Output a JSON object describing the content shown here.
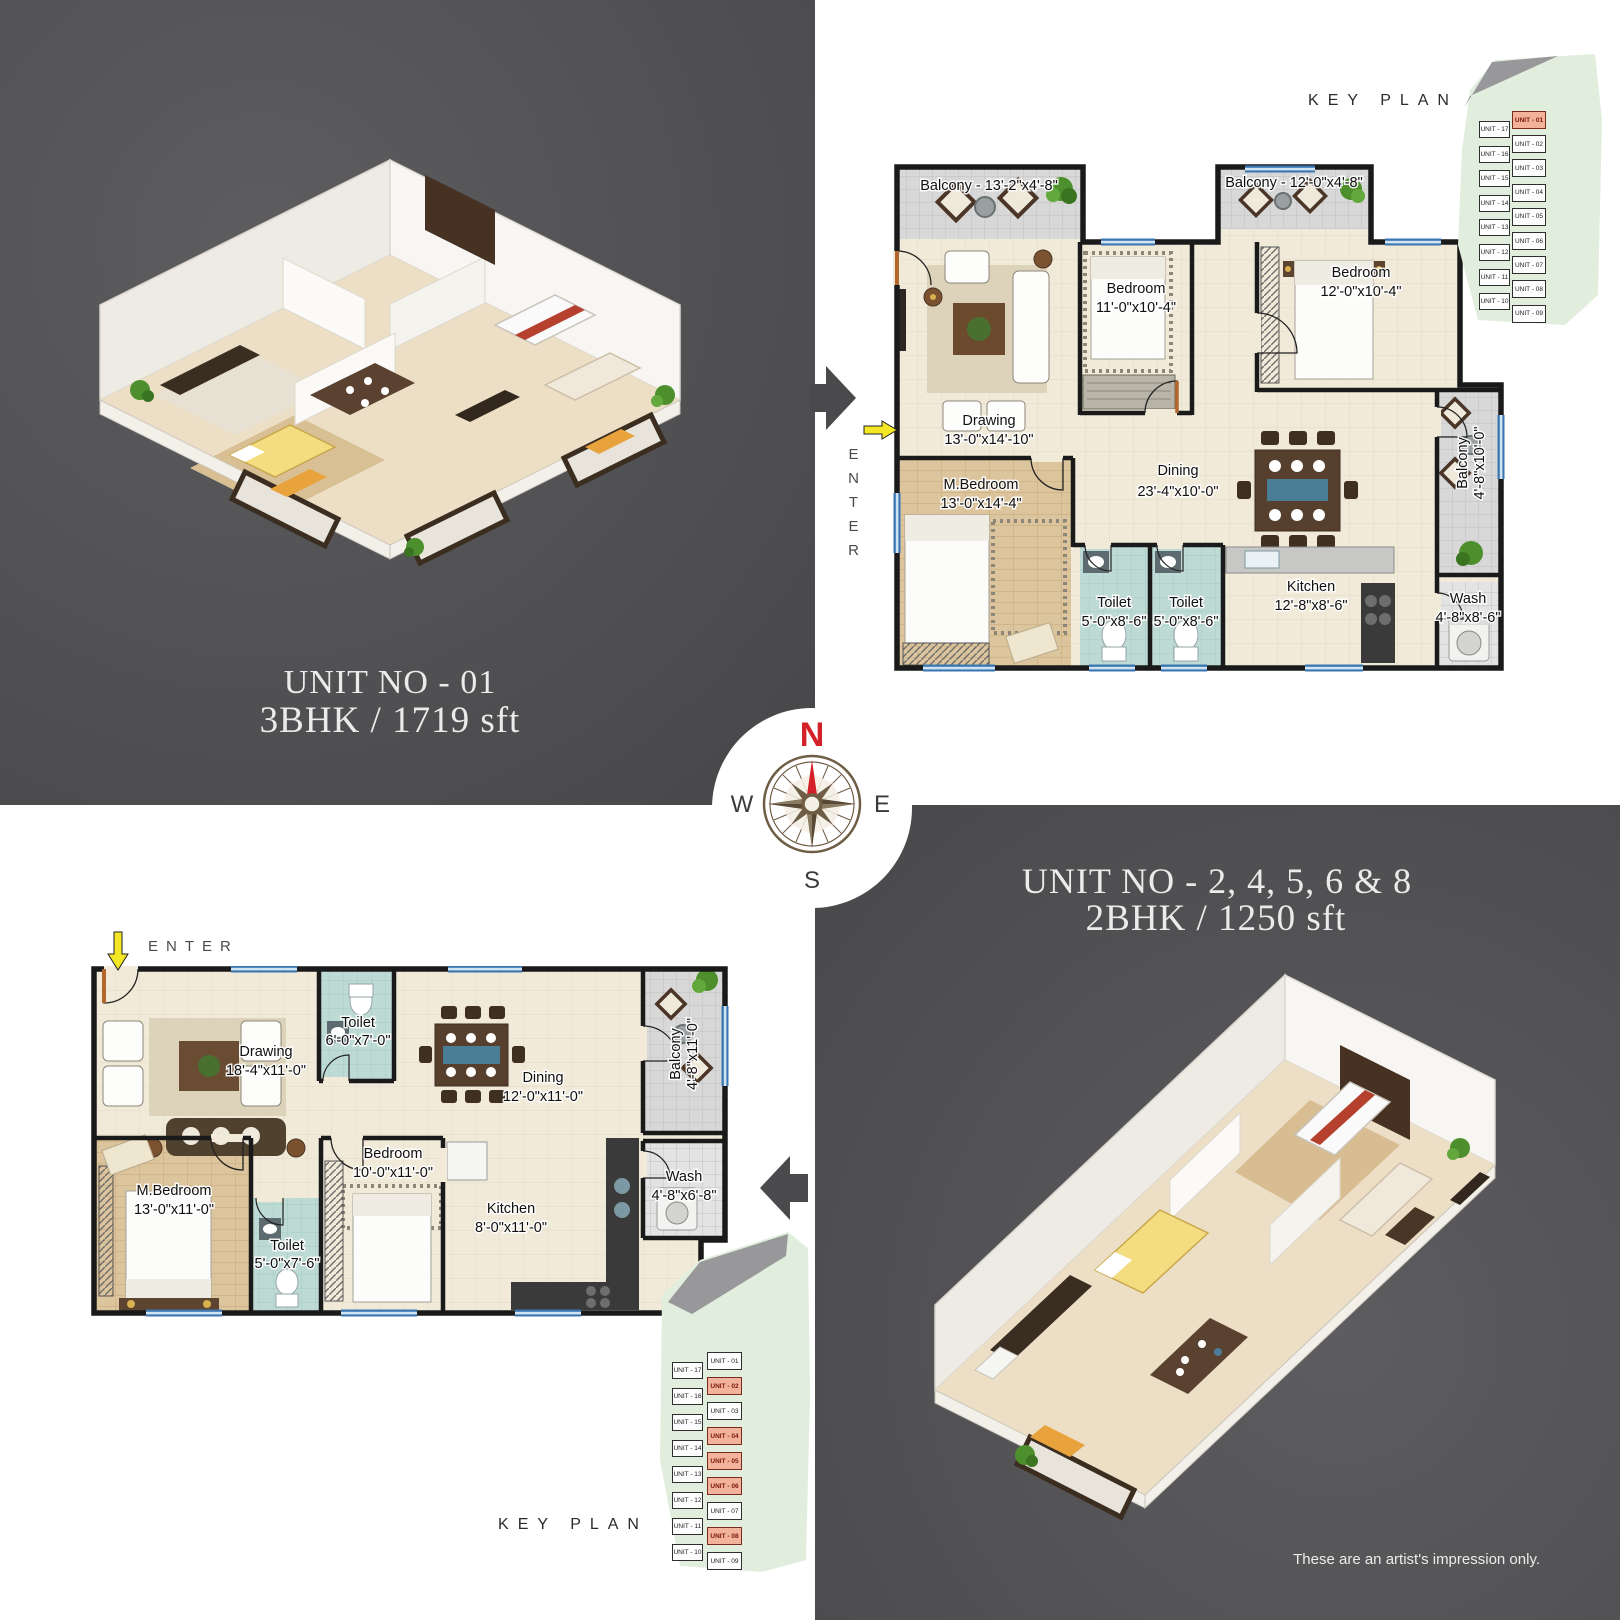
{
  "colors": {
    "panel_dark": "#4d4d4f",
    "accent_red": "#d42028",
    "key_plan_green": "#e2eedd",
    "unit_highlight": "#f2b29c",
    "floor_beige": "#f1ead9",
    "toilet_blue": "#bedad5",
    "balcony_gray": "#d8d8d8",
    "window_blue": "#3a77b0"
  },
  "compass": {
    "north": "N",
    "east": "E",
    "south": "S",
    "west": "W"
  },
  "unit1": {
    "title": "UNIT NO - 01",
    "subtitle": "3BHK / 1719 sft",
    "enter_label": "ENTER",
    "plan": {
      "balcony_tl": "Balcony - 13'-2\"x4'-8\"",
      "balcony_tr": "Balcony - 12'-0\"x4'-8\"",
      "bedroom1_name": "Bedroom",
      "bedroom1_dims": "11'-0\"x10'-4\"",
      "bedroom2_name": "Bedroom",
      "bedroom2_dims": "12'-0\"x10'-4\"",
      "drawing_name": "Drawing",
      "drawing_dims": "13'-0\"x14'-10\"",
      "mbedroom_name": "M.Bedroom",
      "mbedroom_dims": "13'-0\"x14'-4\"",
      "dining_name": "Dining",
      "dining_dims": "23'-4\"x10'-0\"",
      "toilet1_name": "Toilet",
      "toilet1_dims": "5'-0\"x8'-6\"",
      "toilet2_name": "Toilet",
      "toilet2_dims": "5'-0\"x8'-6\"",
      "kitchen_name": "Kitchen",
      "kitchen_dims": "12'-8\"x8'-6\"",
      "balcony_r_name": "Balcony",
      "balcony_r_dims": "4'-8\"x10'-0\"",
      "wash_name": "Wash",
      "wash_dims": "4'-8\"x8'-6\""
    }
  },
  "unit2": {
    "title": "UNIT NO - 2, 4, 5, 6 & 8",
    "subtitle": "2BHK / 1250 sft",
    "enter_label": "ENTER",
    "plan": {
      "drawing_name": "Drawing",
      "drawing_dims": "18'-4\"x11'-0\"",
      "toilet_top_name": "Toilet",
      "toilet_top_dims": "6'-0\"x7'-0\"",
      "dining_name": "Dining",
      "dining_dims": "12'-0\"x11'-0\"",
      "balcony_name": "Balcony",
      "balcony_dims": "4'-8\"x11'-0\"",
      "mbedroom_name": "M.Bedroom",
      "mbedroom_dims": "13'-0\"x11'-0\"",
      "toilet_bottom_name": "Toilet",
      "toilet_bottom_dims": "5'-0\"x7'-6\"",
      "bedroom_name": "Bedroom",
      "bedroom_dims": "10'-0\"x11'-0\"",
      "kitchen_name": "Kitchen",
      "kitchen_dims": "8'-0\"x11'-0\"",
      "wash_name": "Wash",
      "wash_dims": "4'-8\"x6'-8\""
    }
  },
  "key_plan_top": {
    "label": "KEY PLAN",
    "left_column": [
      "UNIT - 17",
      "UNIT - 16",
      "UNIT - 15",
      "UNIT - 14",
      "UNIT - 13",
      "UNIT - 12",
      "UNIT - 11",
      "UNIT - 10"
    ],
    "right_column": [
      "UNIT - 01",
      "UNIT - 02",
      "UNIT - 03",
      "UNIT - 04",
      "UNIT - 05",
      "UNIT - 06",
      "UNIT - 07",
      "UNIT - 08",
      "UNIT - 09"
    ],
    "highlighted": [
      "UNIT - 01"
    ]
  },
  "key_plan_bottom": {
    "label": "KEY PLAN",
    "left_column": [
      "UNIT - 17",
      "UNIT - 16",
      "UNIT - 15",
      "UNIT - 14",
      "UNIT - 13",
      "UNIT - 12",
      "UNIT - 11",
      "UNIT - 10"
    ],
    "right_column": [
      "UNIT - 01",
      "UNIT - 02",
      "UNIT - 03",
      "UNIT - 04",
      "UNIT - 05",
      "UNIT - 06",
      "UNIT - 07",
      "UNIT - 08",
      "UNIT - 09"
    ],
    "highlighted": [
      "UNIT - 02",
      "UNIT - 04",
      "UNIT - 05",
      "UNIT - 06",
      "UNIT - 08"
    ]
  },
  "footer": {
    "disclaimer": "These are an artist's impression only."
  }
}
